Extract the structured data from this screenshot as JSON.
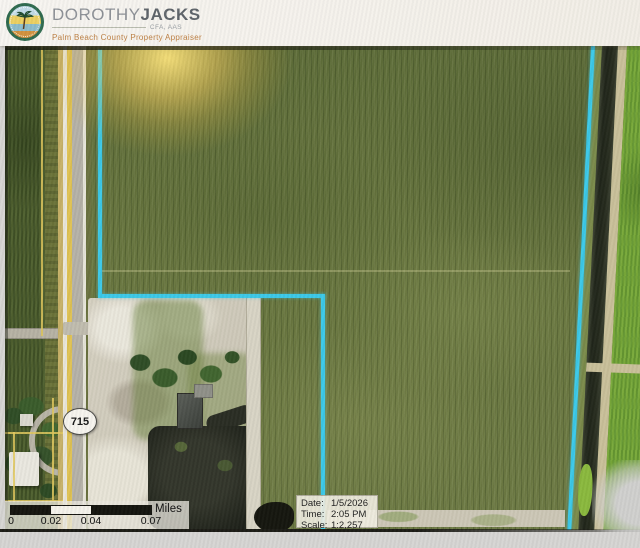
{
  "header": {
    "brand_first": "DOROTHY",
    "brand_last": "JACKS",
    "credentials": "CFA, AAS",
    "subtitle": "Palm Beach County Property Appraiser"
  },
  "map": {
    "route_shield_label": "715",
    "info_box": {
      "date_label": "Date:",
      "date_value": "1/5/2026",
      "time_label": "Time:",
      "time_value": "2:05 PM",
      "scale_label": "Scale:",
      "scale_value": "1:2,257"
    },
    "scale_bar": {
      "ticks": [
        "0",
        "0.02",
        "0.04",
        "0.07"
      ],
      "unit": "Miles"
    },
    "colors": {
      "parcel_boundary_cyan": "#3CC9E8",
      "parcel_lines_yellow": "#E0C85E",
      "road_centerline_yellow": "#DFC253"
    }
  }
}
